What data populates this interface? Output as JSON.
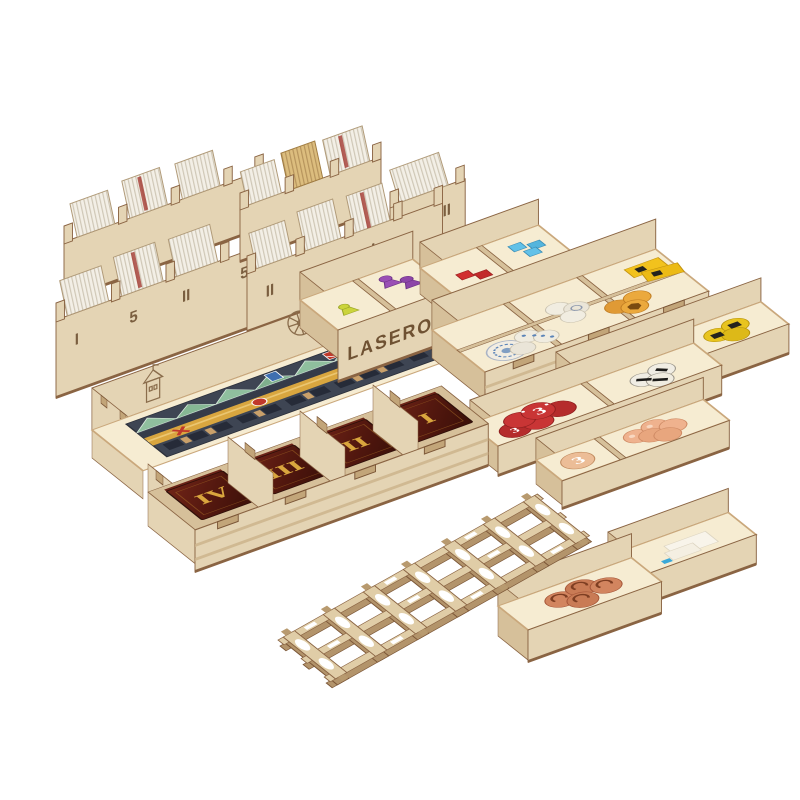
{
  "photo": {
    "description": "Product photo of a laser-cut wooden board game organizer insert, fully assembled and loaded with game components, on a plain white background",
    "background_color": "#ffffff"
  },
  "brand": {
    "left": "LASEROX",
    "right": "LASEROX"
  },
  "racks": {
    "top_left_labels": [
      "I",
      "5",
      "II",
      "5"
    ],
    "top_middle_labels": [
      "II",
      "5",
      "I"
    ],
    "top_middle_right_label": "II"
  },
  "card_wells": {
    "numerals": [
      "IV",
      "III",
      "II",
      "I"
    ]
  },
  "tokens": {
    "blue": {
      "value": "3",
      "color": "#3f86c9"
    },
    "red": {
      "value": "3",
      "color": "#c93535"
    },
    "tan": {
      "value": "3",
      "color": "#ecbd97"
    },
    "yellow": {
      "color": "#e8c41f"
    },
    "orange": {
      "color": "#eba93d"
    },
    "white": {
      "color": "#f0ece0"
    },
    "bread": {
      "color": "#d2855f"
    },
    "egg": {
      "color": "#efb28e"
    }
  },
  "pieces": {
    "meeple_purple": "#9a4fb5",
    "meeple_yellow": "#cbd43c",
    "cube_red": "#d12f2f",
    "cube_blue": "#62c1e8"
  },
  "wood_palette": {
    "light": "#e4d4b4",
    "mid": "#d6c09a",
    "dark": "#c2a579",
    "burnt_edge": "#8a6443",
    "engraving": "#6f5233",
    "inner_glow": "#f6ecd2"
  },
  "board_art": {
    "roof_green": "#8fbf9e",
    "facade_slate": "#3e4553",
    "road_gold": "#d9a63f",
    "accent_red": "#c0392b"
  },
  "card_art": {
    "maroon": "#54180f",
    "gold": "#d9a63e"
  }
}
